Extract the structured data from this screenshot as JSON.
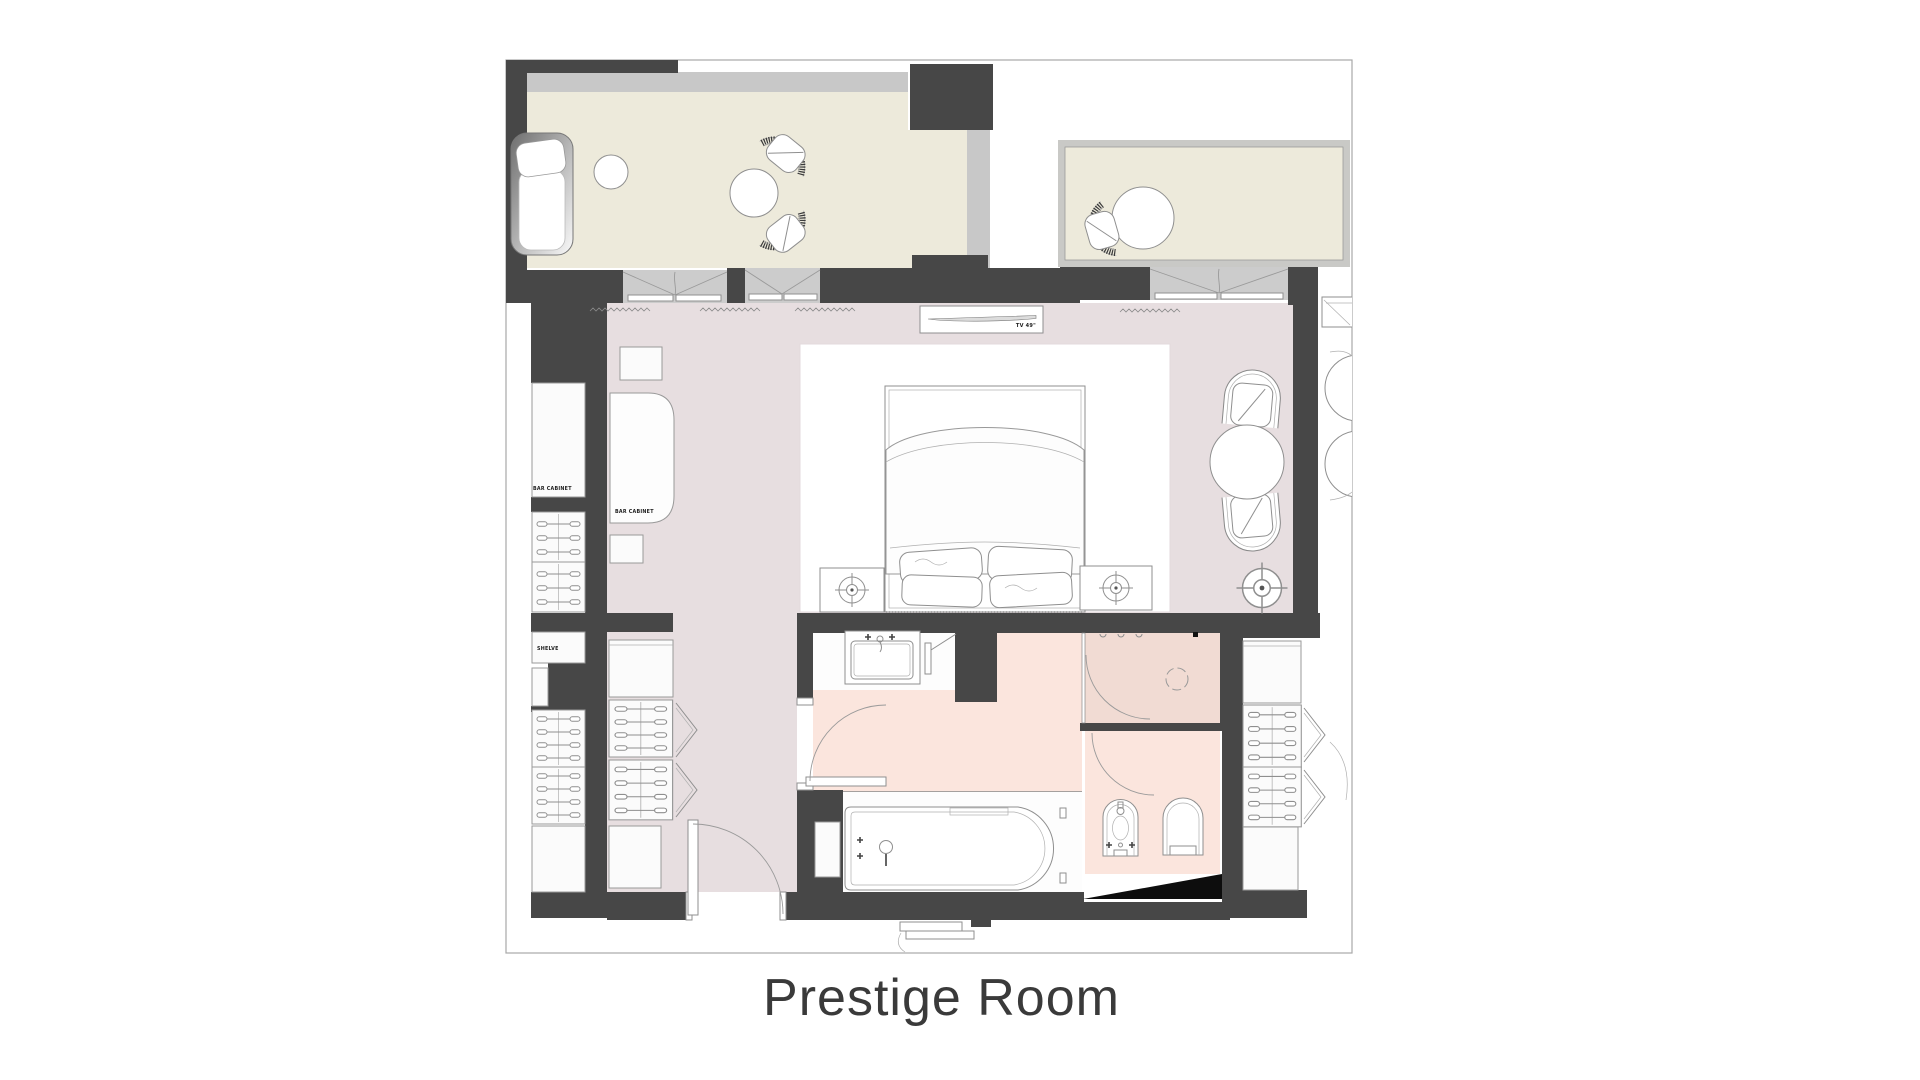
{
  "title": "Prestige Room",
  "labels": {
    "tv": "TV 49\"",
    "bar_cabinet_closet": "BAR CABINET",
    "bar_cabinet_room": "BAR CABINET",
    "shelve": "SHELVE"
  },
  "colors": {
    "wall": "#474747",
    "bedroom_floor": "#e7dee0",
    "bathroom_floor": "#fbe5dd",
    "shower_floor": "#f1dbd3",
    "balcony_floor": "#edeadb",
    "railing": "#c8c8c8",
    "sliding_door": "#cccccc",
    "outline": "#999999",
    "page_border": "#a8a8a8",
    "title_color": "#3a3a3a",
    "accent_black": "#0d0d0d"
  },
  "furniture_symbols": [
    "chaise-longue",
    "ottoman",
    "balcony-table",
    "bistro-chair",
    "double-bed",
    "pillows",
    "nightstand",
    "ceiling-light-symbol",
    "tv-49-inch-shelf",
    "bar-cabinet",
    "drawer-unit",
    "shelve",
    "wardrobe-folding-door",
    "armchair",
    "side-table",
    "floor-lamp",
    "vanity-sink",
    "mirror",
    "bathtub",
    "shower-drain",
    "bidet",
    "toilet"
  ]
}
